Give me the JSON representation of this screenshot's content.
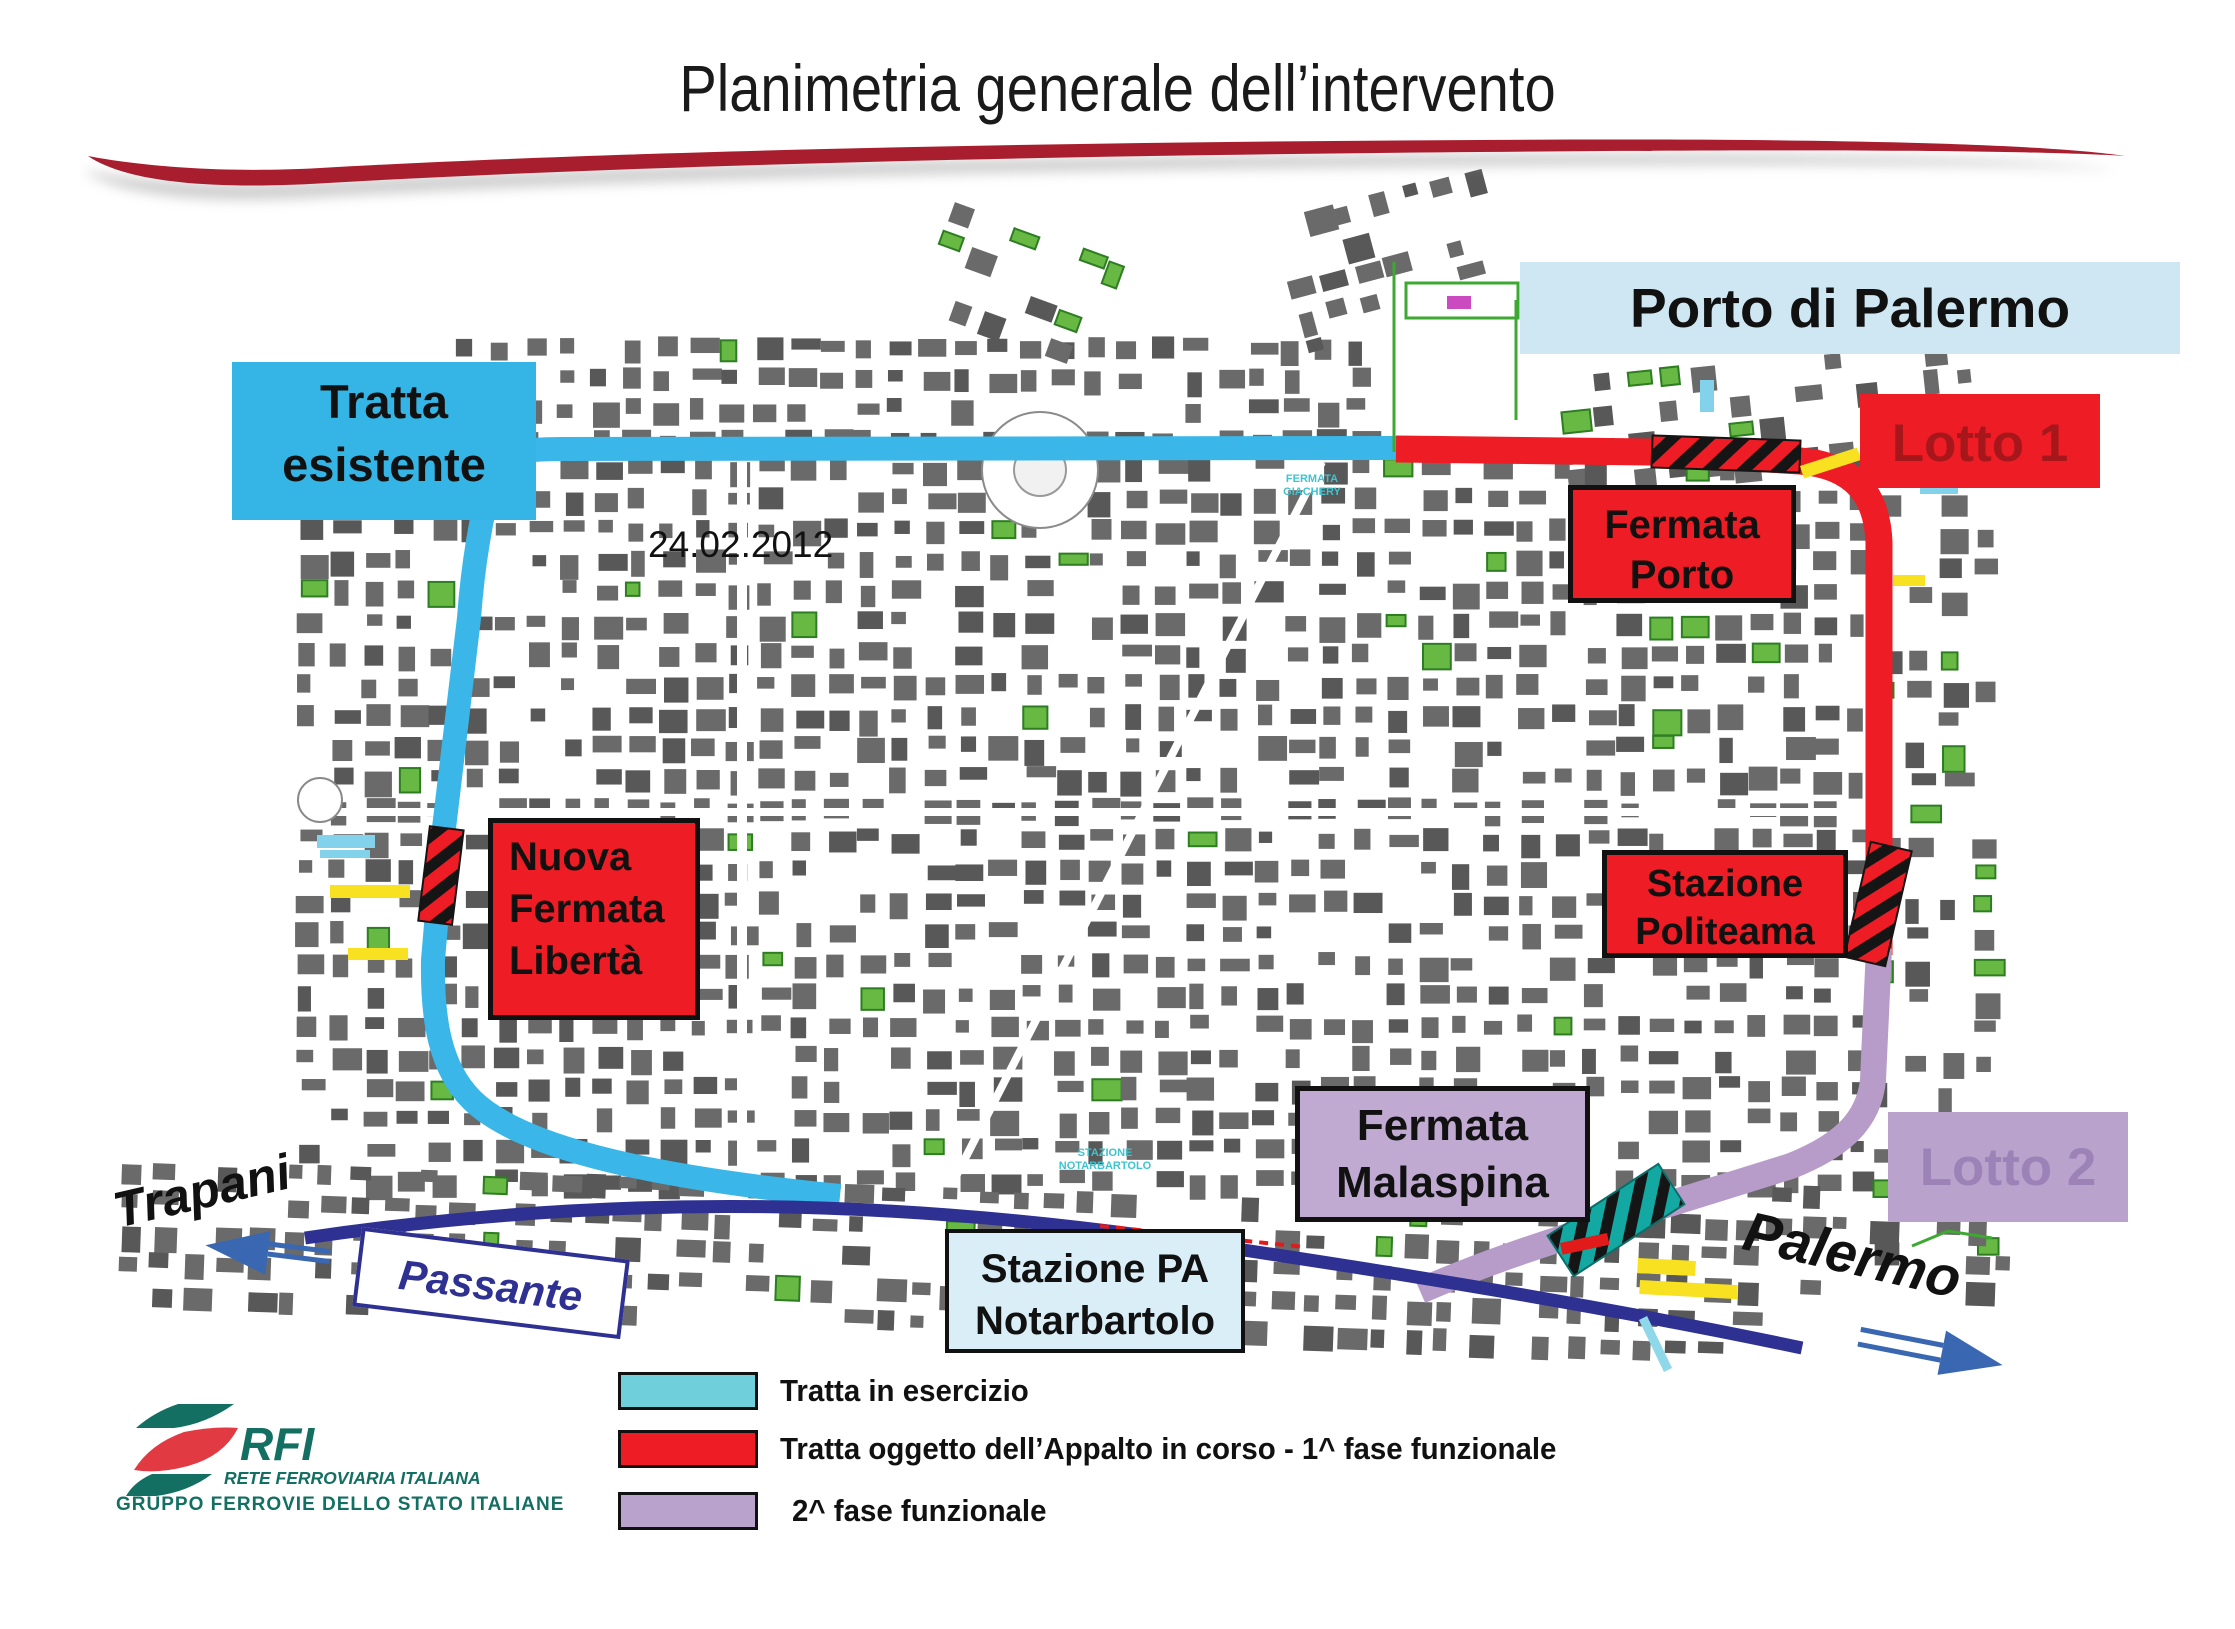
{
  "slide": {
    "title": "Planimetria generale dell’intervento",
    "date_on_map": "24.02.2012"
  },
  "boxes": {
    "porto": {
      "label": "Porto di Palermo",
      "bg": "#cfe7f2"
    },
    "tratta_esistente": {
      "label": "Tratta esistente",
      "bg": "#35b5e5"
    },
    "lotto1": {
      "label": "Lotto 1",
      "bg": "#ee1c24",
      "fg": "#a6171c"
    },
    "lotto2": {
      "label": "Lotto 2",
      "bg": "#b9a3cc",
      "fg": "#9d82b8"
    },
    "fermata_porto": {
      "lines": [
        "Fermata",
        "Porto"
      ],
      "bg": "#ee1c24"
    },
    "nuova_fermata_liberta": {
      "lines": [
        "Nuova",
        "Fermata",
        "Libertà"
      ],
      "bg": "#ee1c24"
    },
    "stazione_politeama": {
      "lines": [
        "Stazione",
        "Politeama"
      ],
      "bg": "#ee1c24"
    },
    "fermata_malaspina": {
      "lines": [
        "Fermata",
        "Malaspina"
      ],
      "bg": "#c0aad2"
    },
    "stazione_notarbartolo": {
      "lines": [
        "Stazione PA",
        "Notarbartolo"
      ],
      "bg": "#d9eef7"
    },
    "passante": {
      "label": "Passante",
      "fg": "#2e3192"
    }
  },
  "direction_labels": {
    "trapani": "Trapani",
    "palermo": "Palermo"
  },
  "map_micro_labels": {
    "stazione_notarbartolo": [
      "STAZIONE",
      "NOTARBARTOLO"
    ],
    "fermata_giachery": [
      "FERMATA",
      "GIACHERY"
    ]
  },
  "legend": {
    "items": [
      {
        "label": "Tratta in esercizio",
        "color": "#6fcfda"
      },
      {
        "label": "Tratta oggetto dell’Appalto in corso - 1^ fase funzionale",
        "color": "#ee1c24"
      },
      {
        "label": "2^ fase funzionale",
        "color": "#b9a3cc"
      }
    ]
  },
  "logo": {
    "name": "RFI",
    "line1": "RETE FERROVIARIA ITALIANA",
    "line2": "GRUPPO FERROVIE DELLO STATO ITALIANE",
    "teal": "#136f62",
    "red": "#e13a43"
  },
  "palette": {
    "existing_line": "#3ab7e8",
    "red": "#ee1c24",
    "phase2_line": "#b79bc9",
    "passante_line": "#2e3192",
    "arrow_blue": "#3a67b1",
    "swoosh": "#a81e2e"
  }
}
